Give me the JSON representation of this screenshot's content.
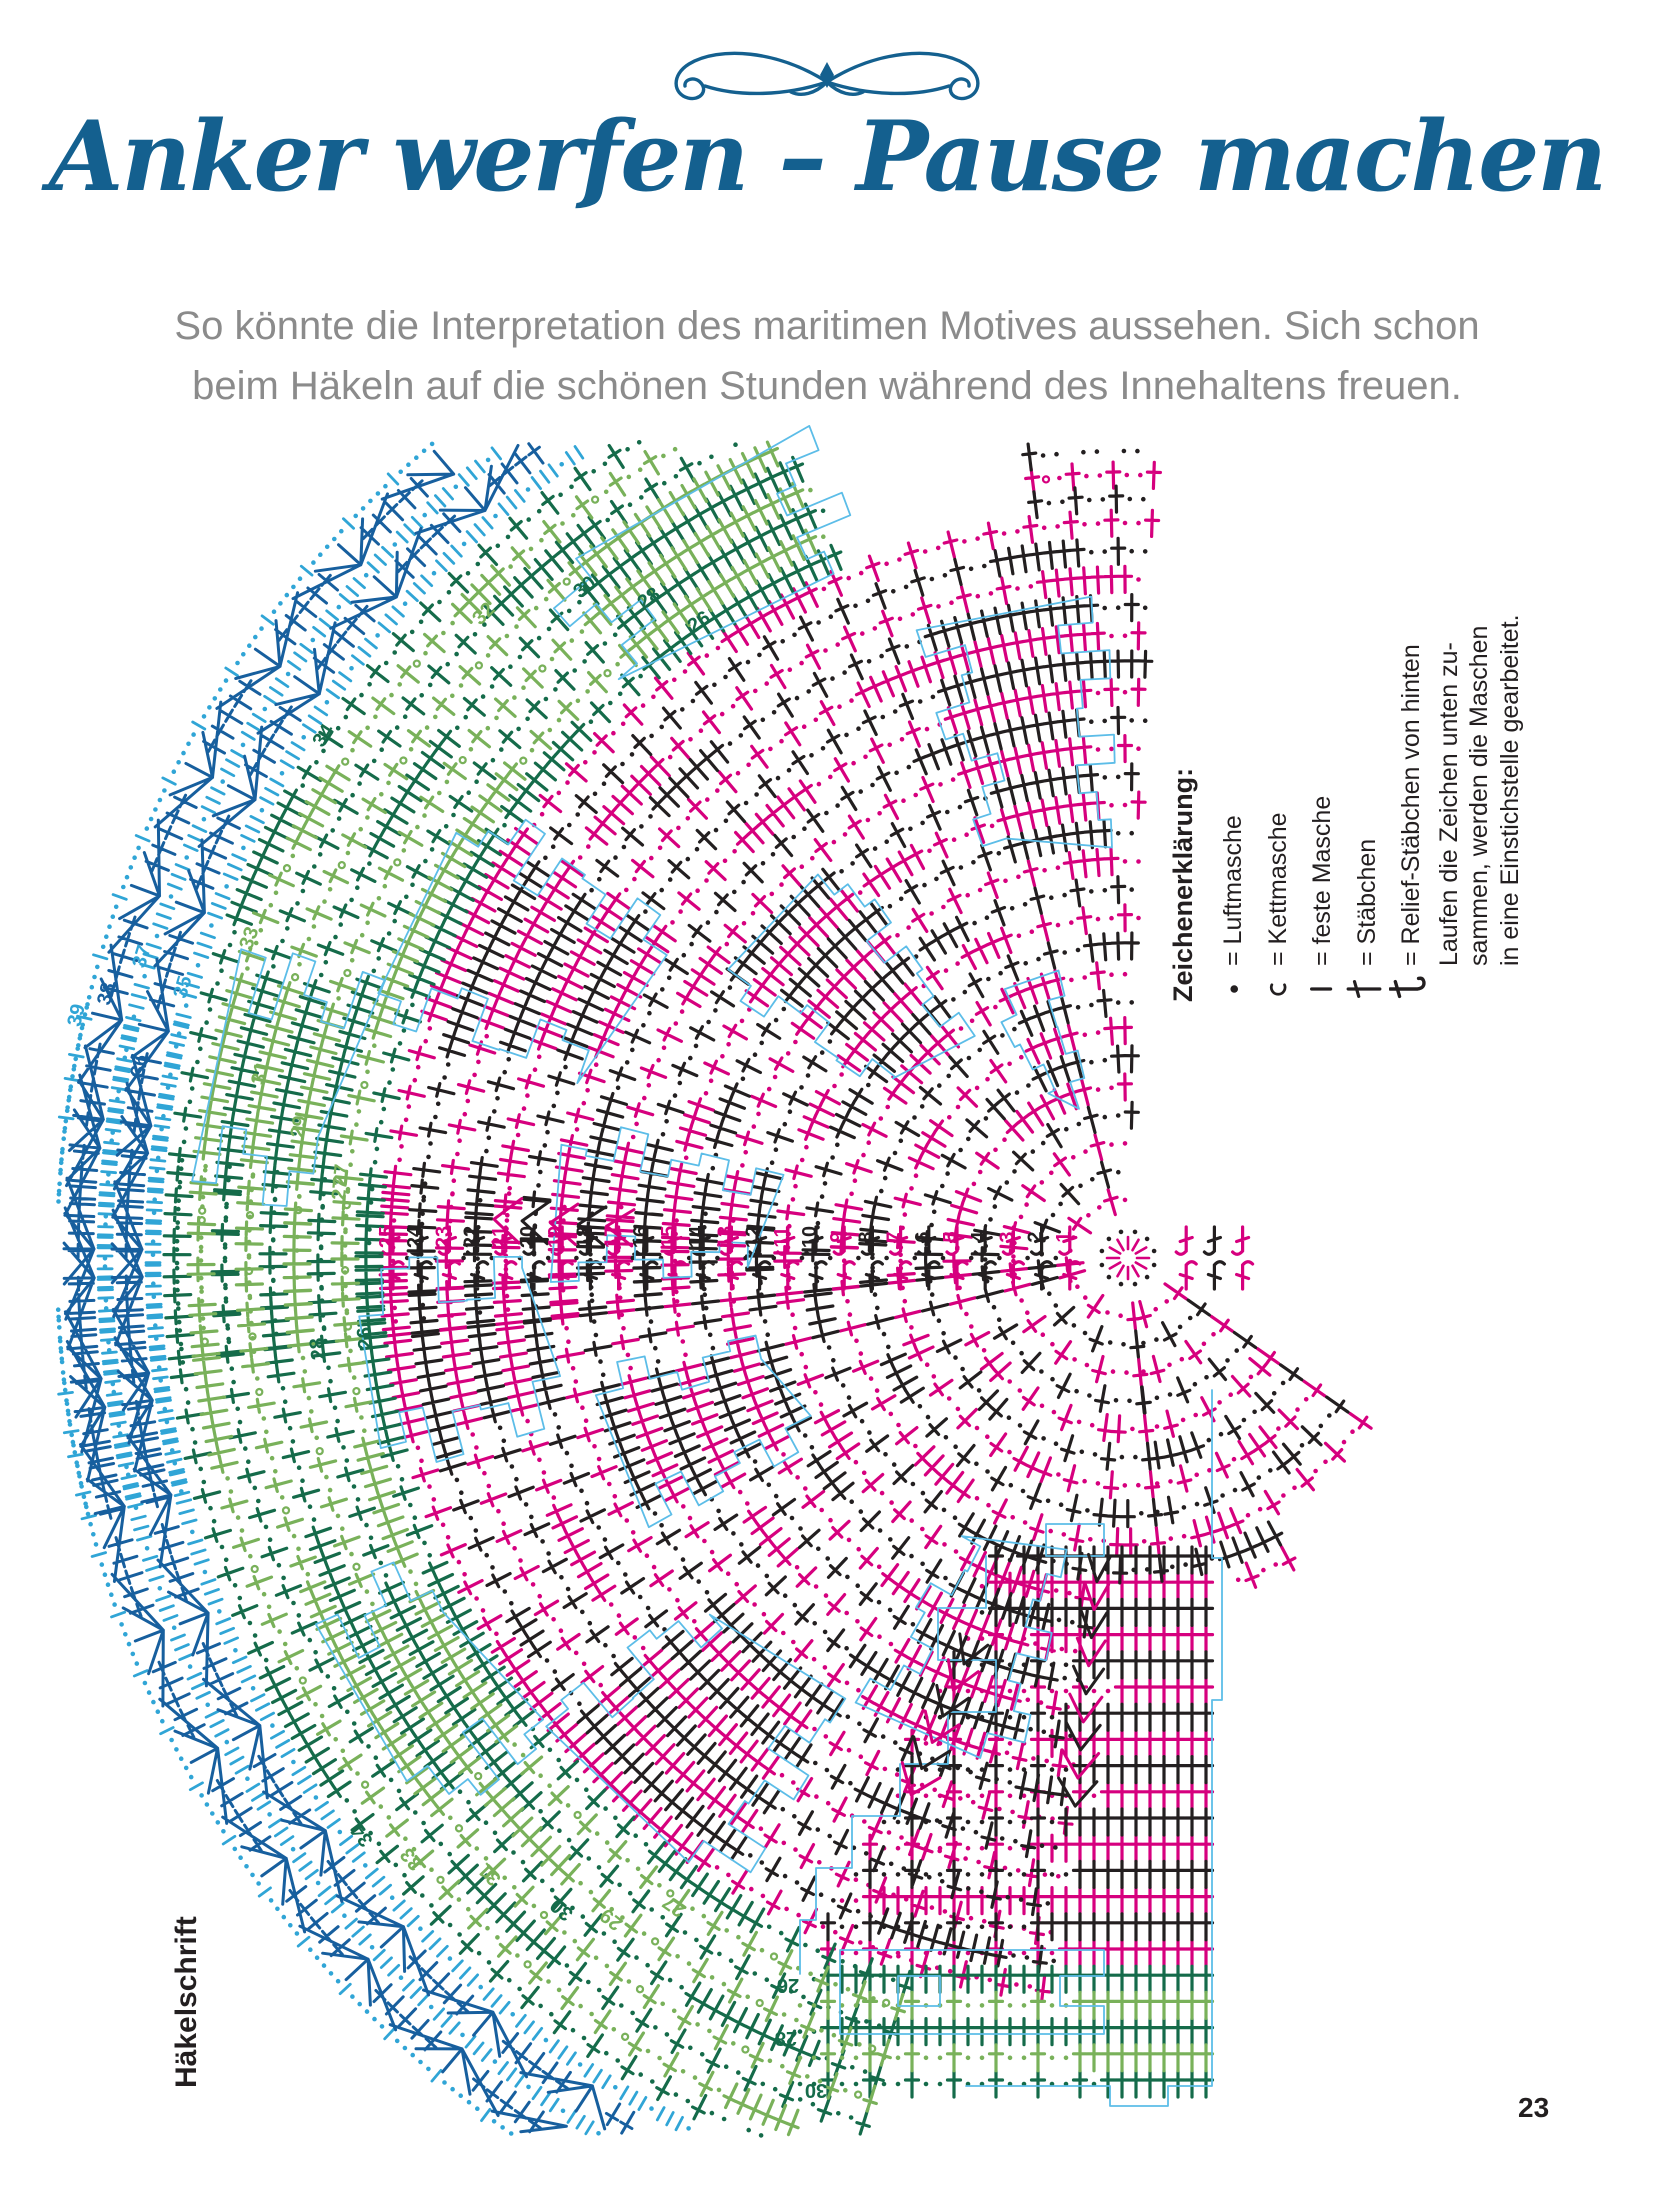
{
  "header": {
    "title": "Anker werfen – Pause machen",
    "subtitle_line1": "So könnte die Interpretation des maritimen Motives aussehen. Sich schon",
    "subtitle_line2": "beim Häkeln auf die schönen Stunden während des Innehaltens freuen."
  },
  "sidebar_label": "Häkelschrift",
  "page_number": "23",
  "legend": {
    "heading": "Zeichenerklärung:",
    "items": [
      {
        "icon": "chain-stitch-icon",
        "label": "= Luftmasche"
      },
      {
        "icon": "slip-stitch-icon",
        "label": "= Kettmasche"
      },
      {
        "icon": "single-crochet-icon",
        "label": "= feste Masche"
      },
      {
        "icon": "double-crochet-icon",
        "label": "= Stäbchen"
      },
      {
        "icon": "relief-double-crochet-icon",
        "label": "= Relief-Stäbchen von hinten"
      }
    ],
    "note_lines": [
      "Laufen die Zeichen unten zu-",
      "sammen, werden die Maschen",
      "in eine Einstichstelle gearbeitet."
    ]
  },
  "colors": {
    "magenta": "#d6007e",
    "black": "#231f20",
    "light_green": "#79b15a",
    "dark_green": "#156b4a",
    "light_blue": "#30a5d6",
    "dark_blue": "#175f9e",
    "outline": "#5cbde8",
    "title_blue": "#14608f",
    "subtitle_gray": "#8b8b8b"
  },
  "diagram": {
    "center": {
      "x": 1128,
      "y": 1258
    },
    "r0": 30,
    "step": 28.2,
    "step_outer": 24,
    "axis_numbers": [
      "1",
      "2",
      "3",
      "4",
      "5",
      "6",
      "7",
      "8",
      "9",
      "10",
      "11",
      "12",
      "13",
      "14",
      "15",
      "16",
      "17",
      "18",
      "19",
      "20",
      "21",
      "22",
      "23",
      "24",
      "25"
    ],
    "zones": [
      {
        "fan": "top",
        "rings": [
          1,
          25
        ],
        "a0": -186,
        "a1": -88,
        "palette": [
          "magenta",
          "black"
        ]
      },
      {
        "fan": "top",
        "rings": [
          26,
          28
        ],
        "a0": -97,
        "a1": -88,
        "palette": [
          "magenta",
          "black"
        ]
      },
      {
        "fan": "top",
        "rings": [
          26,
          34
        ],
        "a0": -186,
        "a1": -112,
        "palette": [
          "light_green",
          "dark_green"
        ]
      },
      {
        "fan": "top",
        "rings": [
          35,
          39
        ],
        "a0": -194,
        "a1": -114,
        "palette": [
          "light_blue",
          "dark_blue"
        ],
        "style": "scallop"
      },
      {
        "fan": "bottom",
        "rings": [
          1,
          25
        ],
        "a0": 84,
        "a1": 186,
        "palette": [
          "magenta",
          "black"
        ]
      },
      {
        "fan": "bottom",
        "rings": [
          1,
          9
        ],
        "a0": 35,
        "a1": 84,
        "palette": [
          "magenta",
          "black"
        ]
      },
      {
        "fan": "bottom",
        "rings": [
          10,
          19
        ],
        "a0": 62,
        "a1": 84,
        "palette": [
          "magenta",
          "black"
        ]
      },
      {
        "fan": "bottom",
        "rings": [
          26,
          34
        ],
        "a0": 107,
        "a1": 186,
        "palette": [
          "light_green",
          "dark_green"
        ]
      },
      {
        "fan": "bottom",
        "rings": [
          35,
          39
        ],
        "a0": 110,
        "a1": 194,
        "palette": [
          "light_blue",
          "dark_blue"
        ],
        "style": "scallop"
      }
    ],
    "blocks": [
      {
        "fan": "top",
        "r0": 14,
        "r1": 22,
        "a": -94,
        "w": -13
      },
      {
        "fan": "top",
        "r0": 26,
        "r1": 31,
        "a": -113,
        "w": -16
      },
      {
        "fan": "top",
        "r0": 9,
        "r1": 16,
        "a": -127,
        "w": -17
      },
      {
        "fan": "top",
        "r0": 19,
        "r1": 27,
        "a": -146,
        "w": -14
      },
      {
        "fan": "top",
        "r0": 28,
        "r1": 33,
        "a": -162,
        "w": -12
      },
      {
        "fan": "top",
        "r0": 12,
        "r1": 19,
        "a": -168,
        "w": -12
      },
      {
        "fan": "top",
        "r0": 5,
        "r1": 9,
        "a": -106,
        "w": -10
      },
      {
        "fan": "bottom",
        "r0": 10,
        "r1": 17,
        "a": 104,
        "w": 15
      },
      {
        "fan": "bottom",
        "r0": 18,
        "r1": 25,
        "a": 124,
        "w": 16
      },
      {
        "fan": "bottom",
        "r0": 26,
        "r1": 31,
        "a": 142,
        "w": 13
      },
      {
        "fan": "bottom",
        "r0": 12,
        "r1": 18,
        "a": 152,
        "w": 14
      },
      {
        "fan": "bottom",
        "r0": 20,
        "r1": 26,
        "a": 166,
        "w": 12
      }
    ],
    "decreases": [
      {
        "fan": "top",
        "a": -176.5,
        "r0": 17,
        "r1": 21
      },
      {
        "fan": "bottom",
        "a": 95.5,
        "r0": 10,
        "r1": 18
      },
      {
        "fan": "bottom",
        "a": 112,
        "r0": 14,
        "r1": 19
      }
    ],
    "ring_labels": [
      {
        "n": "26",
        "a": -124,
        "c": "dark_green"
      },
      {
        "n": "28",
        "a": -126,
        "c": "dark_green"
      },
      {
        "n": "30",
        "a": -129,
        "c": "dark_green"
      },
      {
        "n": "32",
        "a": -135,
        "c": "light_green"
      },
      {
        "n": "34",
        "a": -147,
        "c": "dark_green"
      },
      {
        "n": "27",
        "a": -175,
        "c": "light_green"
      },
      {
        "n": "29",
        "a": -171,
        "c": "light_green"
      },
      {
        "n": "31",
        "a": -168,
        "c": "light_green"
      },
      {
        "n": "33",
        "a": -160,
        "c": "light_green"
      },
      {
        "n": "35",
        "a": -164,
        "c": "light_blue"
      },
      {
        "n": "36",
        "a": -169,
        "c": "dark_blue"
      },
      {
        "n": "37",
        "a": -163,
        "c": "light_blue"
      },
      {
        "n": "38",
        "a": -165.5,
        "c": "dark_blue"
      },
      {
        "n": "39",
        "a": -167,
        "c": "light_blue"
      },
      {
        "n": "26",
        "a": -186,
        "c": "dark_green"
      },
      {
        "n": "28",
        "a": -186.4,
        "c": "dark_green"
      },
      {
        "n": "27",
        "a": 186,
        "c": "light_green"
      },
      {
        "n": "29",
        "a": 128,
        "c": "light_green"
      },
      {
        "n": "27",
        "a": 125,
        "c": "light_green"
      },
      {
        "n": "31",
        "a": 136,
        "c": "light_green"
      },
      {
        "n": "33",
        "a": 140,
        "c": "light_green"
      },
      {
        "n": "34",
        "a": 143,
        "c": "dark_green"
      },
      {
        "n": "30",
        "a": 131,
        "c": "dark_green"
      }
    ],
    "grid": {
      "y0": 1560,
      "row_step": 26.2,
      "rings": [
        10,
        30
      ],
      "x_right": 1206,
      "solid_rows": [
        10,
        11,
        12,
        23,
        26,
        28
      ],
      "labels": [
        {
          "n": "26",
          "x": 788,
          "y": 1979
        },
        {
          "n": "28",
          "x": 786,
          "y": 2032
        },
        {
          "n": "30",
          "x": 816,
          "y": 2084
        }
      ],
      "outline_paths": [
        "M1212,1390 L1212,1558 L1222,1558 L1222,1700 L1212,1700 L1212,2086 L1168,2086 L1168,2106 L1110,2106 L1110,2086 L966,2086",
        "M986,1556 L986,1608 L938,1608 L938,1660 L996,1660 L996,1712 L948,1712 L948,1764 L900,1764 L900,1816 L852,1816 L852,1868 L816,1868 L816,1920 L800,1920 L800,1974",
        "M840,1950 L1104,1950 L1104,1976 L1060,1976 L1060,2006 L1104,2006 L1104,2034 L840,2034 Z",
        "M898,1976 L940,1976 L940,2006 L898,2006 Z",
        "M1046,1524 L1104,1524 L1104,1556 L1046,1556 Z"
      ]
    }
  }
}
